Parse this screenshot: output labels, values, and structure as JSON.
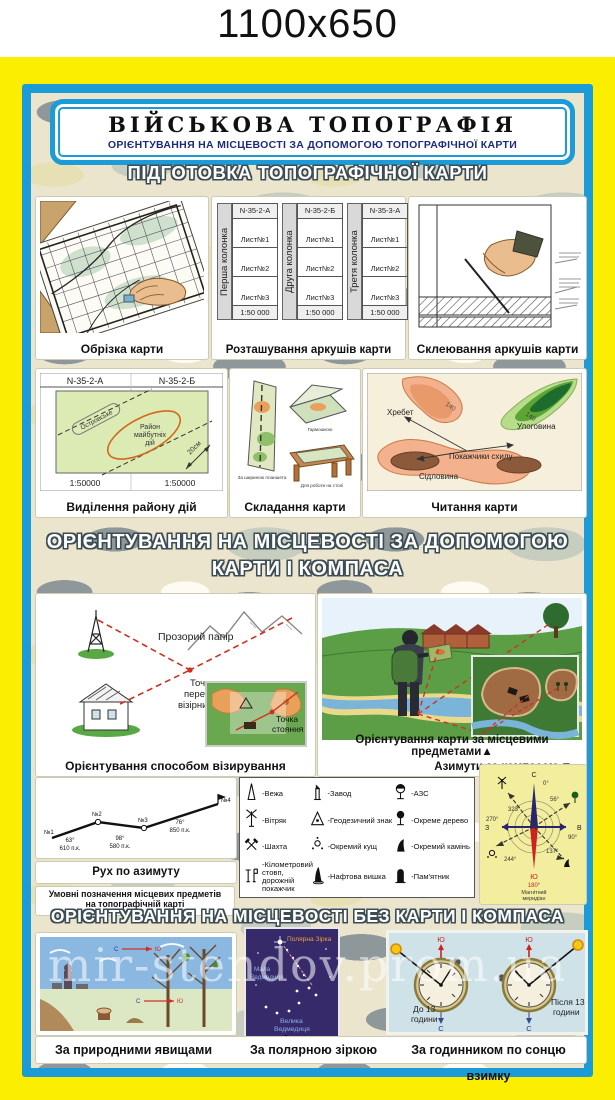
{
  "page": {
    "size_label": "1100x650",
    "watermark": "mir-stendov.prom.ua"
  },
  "banner": {
    "title": "ВІЙСЬКОВА ТОПОГРАФІЯ",
    "subtitle": "ОРІЄНТУВАННЯ НА МІСЦЕВОСТІ ЗА ДОПОМОГОЮ ТОПОГРАФІЧНОЇ КАРТИ"
  },
  "prep": {
    "header": "ПІДГОТОВКА ТОПОГРАФІЧНОЇ КАРТИ",
    "cut_caption": "Обрізка карти",
    "layout_caption": "Розташування аркушів карти",
    "glue_caption": "Склеювання аркушів карти",
    "columns": [
      {
        "side": "Перша колонка",
        "code": "N-35-2-А",
        "sheets": [
          "Лист№1",
          "Лист№2",
          "Лист№3"
        ],
        "scale": "1:50 000"
      },
      {
        "side": "Друга колонка",
        "code": "N-35-2-Б",
        "sheets": [
          "Лист№1",
          "Лист№2",
          "Лист№3"
        ],
        "scale": "1:50 000"
      },
      {
        "side": "Третя колонка",
        "code": "N-35-3-А",
        "sheets": [
          "Лист№1",
          "Лист№2",
          "Лист№3"
        ],
        "scale": "1:50 000"
      }
    ],
    "area": {
      "caption": "Виділення району дій",
      "code_left": "N-35-2-А",
      "code_right": "N-35-2-Б",
      "strip": "Островське",
      "r1": "Район",
      "r2": "майбутніх",
      "r3": "дій",
      "dim": "20см",
      "scale_left": "1:50000",
      "scale_right": "1:50000"
    },
    "fold": {
      "caption": "Складання карти",
      "l1": "За шириною планшета",
      "l2": "Гармошкою",
      "l3": "Для роботи на столі"
    },
    "read": {
      "caption": "Читання карти",
      "ridge": "Хребет",
      "hollow": "Улоговина",
      "slope": "Покажчики схилу",
      "saddle": "Сідловина",
      "c1": "140",
      "c2": "140"
    }
  },
  "compass_sec": {
    "header1": "ОРІЄНТУВАННЯ НА МІСЦЕВОСТІ ЗА ДОПОМОГОЮ",
    "header2": "КАРТИ І КОМПАСА",
    "sight": {
      "caption": "Орієнтування способом візирування",
      "paper": "Прозорий папір",
      "i1": "Точка",
      "i2": "перетину",
      "i3": "візірних ліній",
      "s1": "Точка",
      "s2": "стояння"
    },
    "orient": {
      "cap1": "Орієнтування карти за місцевими предметами▲",
      "cap2": "Азимути за компасом ▼"
    },
    "route": {
      "caption": "Рух по азимуту",
      "p1": "№1",
      "p2": "№2",
      "p3": "№3",
      "p4": "№4",
      "a1": "63°",
      "d1": "610 п.к.",
      "a2": "98°",
      "d2": "580 п.к.",
      "a3": "76°",
      "d3": "850 п.к."
    },
    "legend_title1": "Умовні позначення місцевих предметів",
    "legend_title2": "на топографічній карті",
    "legend": [
      {
        "name": "-Вежа"
      },
      {
        "name": "-Завод"
      },
      {
        "name": "-АЗС"
      },
      {
        "name": "-Вітряк"
      },
      {
        "name": "-Геодезичний знак"
      },
      {
        "name": "-Окреме дерево"
      },
      {
        "name": "-Шахта"
      },
      {
        "name": "-Окремий кущ"
      },
      {
        "name": "-Окремий камінь"
      },
      {
        "name": "-Кілометровий стовп, дорожній покажчик"
      },
      {
        "name": "-Нафтова вишка"
      },
      {
        "name": "-Пам'ятник"
      }
    ],
    "rose": {
      "n": "С",
      "e": "В",
      "s": "Ю",
      "w": "З",
      "d0": "0°",
      "d90": "90°",
      "d180": "180°",
      "d270": "270°",
      "az1": "56°",
      "az2": "137°",
      "az3": "244°",
      "az4": "323°",
      "mer1": "Магнітний",
      "mer2": "меридіан"
    }
  },
  "nocompass": {
    "header": "ОРІЄНТУВАННЯ НА МІСЦЕВОСТІ БЕЗ КАРТИ І КОМПАСА",
    "nature": {
      "caption": "За природними явищами",
      "n": "С",
      "s": "Ю"
    },
    "stars": {
      "caption": "За полярною зіркою",
      "polaris": "Полярна Зірка",
      "um1": "Мала",
      "um2": "Ведмедиця",
      "ub1": "Велика",
      "ub2": "Ведмедиця"
    },
    "watch": {
      "caption": "За годинником по сонцю взимку",
      "b1": "До 13",
      "b2": "години",
      "a1": "Після 13",
      "a2": "години",
      "south": "Ю",
      "north": "С"
    }
  }
}
